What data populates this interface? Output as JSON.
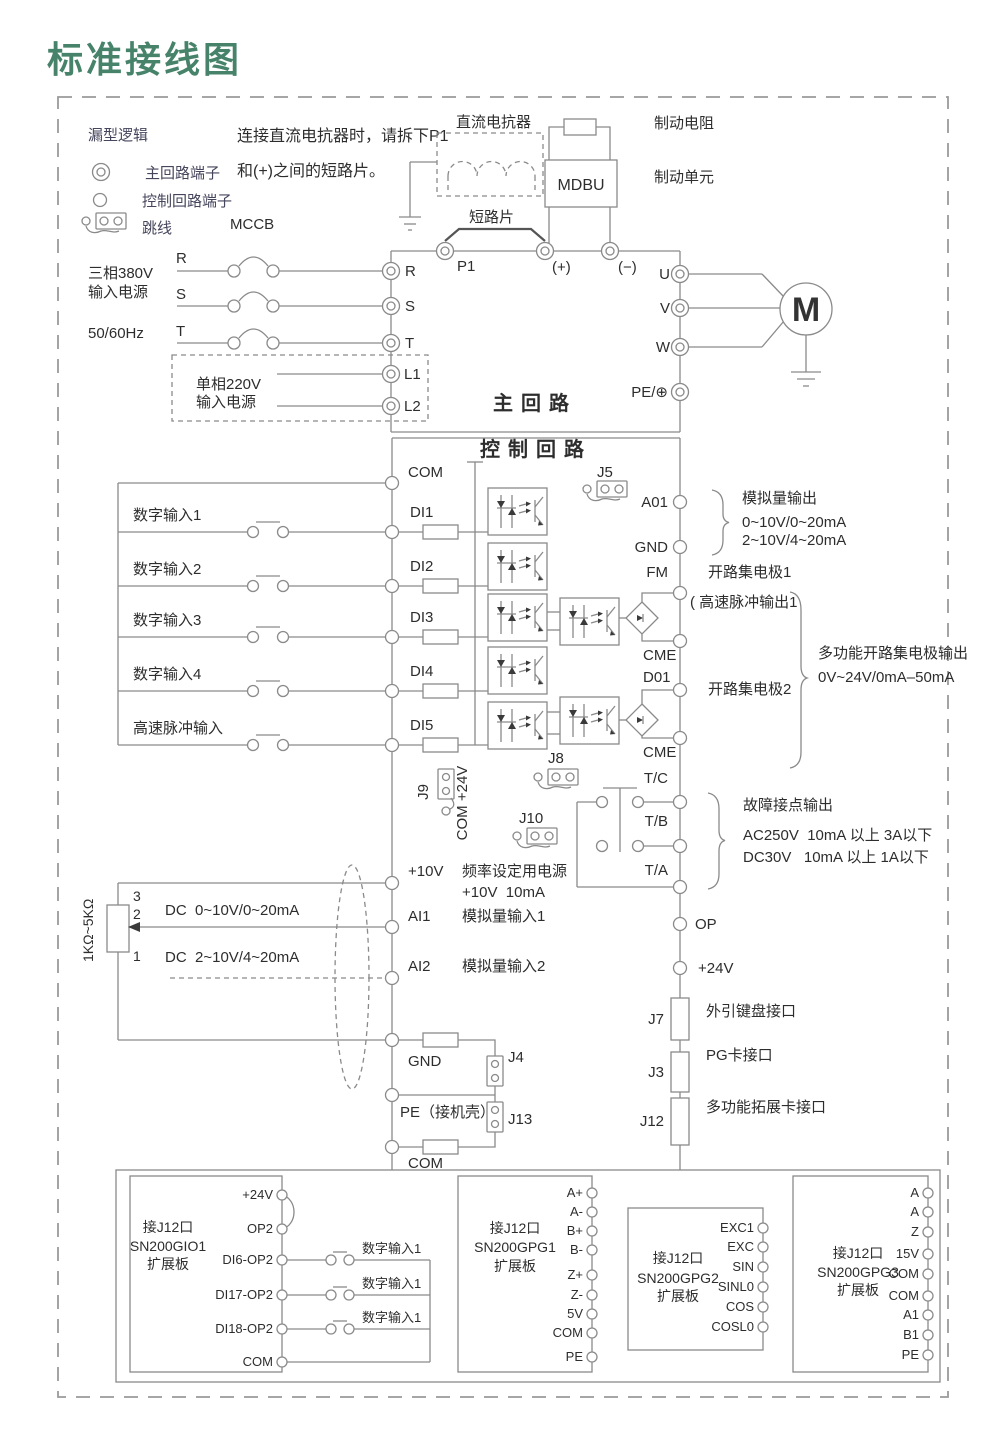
{
  "title": "标准接线图",
  "legend": {
    "heading": "漏型逻辑",
    "main_terminal": "主回路端子",
    "control_terminal": "控制回路端子",
    "jumper": "跳线"
  },
  "note": {
    "line1": "连接直流电抗器时，请拆下P1",
    "line2": "和(+)之间的短路片。"
  },
  "power": {
    "mccb": "MCCB",
    "three_phase1": "三相380V",
    "three_phase2": "输入电源",
    "freq": "50/60Hz",
    "r": "R",
    "s": "S",
    "t": "T",
    "single1": "单相220V",
    "single2": "输入电源"
  },
  "main": {
    "label": "主回路",
    "l1": "L1",
    "l2": "L2",
    "p1": "P1",
    "plus": "(+)",
    "minus": "(−)",
    "u": "U",
    "v": "V",
    "w": "W",
    "pe": "PE/⊕",
    "reactor": "直流电抗器",
    "short_bar": "短路片",
    "mdbu": "MDBU",
    "brake_res": "制动电阻",
    "brake_unit": "制动单元",
    "motor": "M"
  },
  "ctl": {
    "label": "控制回路",
    "com": "COM",
    "di": [
      "DI1",
      "DI2",
      "DI3",
      "DI4",
      "DI5"
    ],
    "din": [
      "数字输入1",
      "数字输入2",
      "数字输入3",
      "数字输入4",
      "高速脉冲输入"
    ],
    "j5": "J5",
    "j8": "J8",
    "j9": "J9",
    "j9t": "COM +24V",
    "j10": "J10",
    "j4": "J4",
    "j13": "J13",
    "a01": "A01",
    "gnd_r": "GND",
    "fm": "FM",
    "cme1": "CME",
    "d01": "D01",
    "cme2": "CME",
    "tc": "T/C",
    "tb": "T/B",
    "ta": "T/A",
    "op": "OP",
    "p24": "+24V",
    "p10": "+10V",
    "freq1": "频率设定用电源",
    "freq2": "+10V  10mA",
    "ai1": "AI1",
    "ai1l": "模拟量输入1",
    "ai2": "AI2",
    "ai2l": "模拟量输入2",
    "dc1": "DC  0~10V/0~20mA",
    "dc2": "DC  2~10V/4~20mA",
    "pot": "1KΩ~5KΩ",
    "pin3": "3",
    "pin2": "2",
    "pin1": "1",
    "gnd": "GND",
    "pe": "PE（接机壳）",
    "com2": "COM",
    "j7": "J7",
    "j3": "J3",
    "j12": "J12",
    "kb": "外引键盘接口",
    "pg": "PG卡接口",
    "exp": "多功能拓展卡接口"
  },
  "ann": {
    "analog_title": "模拟量输出",
    "analog1": "0~10V/0~20mA",
    "analog2": "2~10V/4~20mA",
    "oc1": "开路集电极1",
    "pulse": "( 高速脉冲输出1",
    "oc2": "开路集电极2",
    "multi1": "多功能开路集电极输出",
    "multi2": "0V~24V/0mA–50mA",
    "fault_title": "故障接点输出",
    "fault_ac": "AC250V  10mA 以上 3A以下",
    "fault_dc": "DC30V   10mA 以上 1A以下"
  },
  "boards": {
    "gio1": {
      "l1": "接J12口",
      "l2": "SN200GIO1",
      "l3": "扩展板",
      "t": [
        "+24V",
        "OP2",
        "DI6-OP2",
        "DI17-OP2",
        "DI18-OP2",
        "COM"
      ],
      "sw": [
        "数字输入1",
        "数字输入1",
        "数字输入1"
      ]
    },
    "gpg1": {
      "l1": "接J12口",
      "l2": "SN200GPG1",
      "l3": "扩展板",
      "t": [
        "A+",
        "A-",
        "B+",
        "B-",
        "Z+",
        "Z-",
        "5V",
        "COM",
        "PE"
      ]
    },
    "gpg2": {
      "l1": "接J12口",
      "l2": "SN200GPG2",
      "l3": "扩展板",
      "t": [
        "EXC1",
        "EXC",
        "SIN",
        "SINL0",
        "COS",
        "COSL0"
      ]
    },
    "gpg3": {
      "l1": "接J12口",
      "l2": "SN200GPG3",
      "l3": "扩展板",
      "t": [
        "A",
        "A",
        "Z",
        "15V",
        "COM",
        "COM",
        "A1",
        "B1",
        "PE"
      ]
    }
  },
  "colors": {
    "title_green": "#47836a",
    "line": "#8a8a8a",
    "text": "#2d2d2d",
    "legend_text": "#45455c"
  }
}
